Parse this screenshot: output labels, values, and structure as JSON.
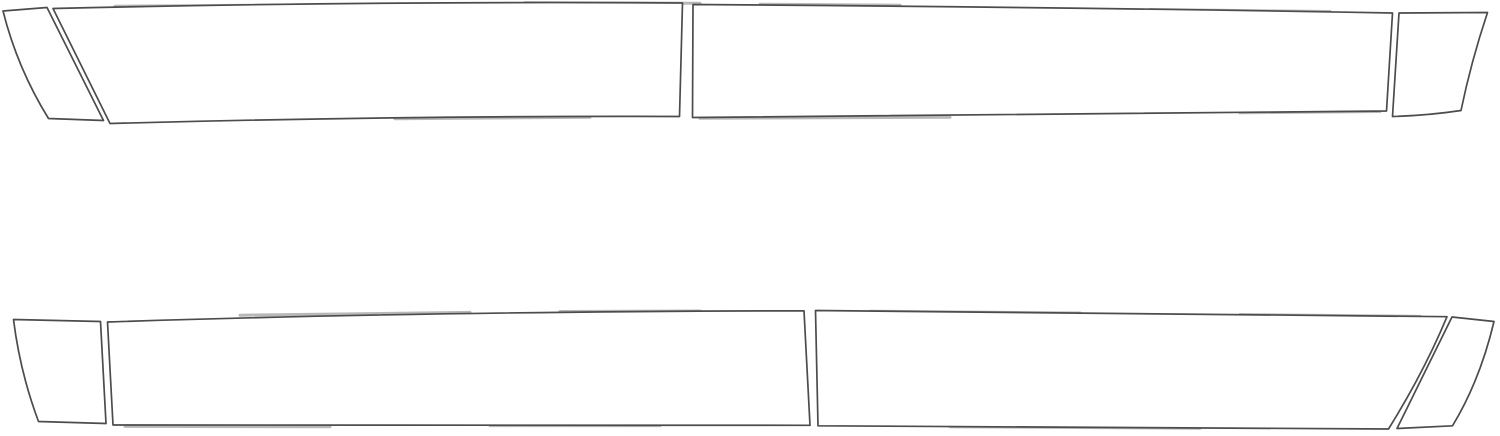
{
  "canvas": {
    "width": 1500,
    "height": 436,
    "viewbox": "0 0 1500 436",
    "background": "#ffffff"
  },
  "style": {
    "outline_color": "#4c4c4c",
    "outline_width": 1.7,
    "piece_fill": "#ffffff",
    "artifact_color": "#b8b8b8",
    "artifact_width": 3
  },
  "diagram": {
    "kind": "precut-film-template-outlines",
    "rows": [
      {
        "id": "top-row",
        "piece_count": 4
      },
      {
        "id": "bottom-row",
        "piece_count": 4
      }
    ]
  },
  "pieces": [
    {
      "id": "top-front-fender-strip",
      "row": "top-row",
      "path": "M 3,11 L 47,7.5 L 103.5,120.5 L 48.5,118.5 Q 17.5,68.5 3,11 Z"
    },
    {
      "id": "top-front-door-panel",
      "row": "top-row",
      "path": "M 53,8.5 Q 372,1 682.5,3 L 679.5,116.5 Q 405,115.5 110,123.5 Z"
    },
    {
      "id": "top-rear-door-panel",
      "row": "top-row",
      "path": "M 693,4.5 Q 1057,7 1392.5,13 L 1386.5,111 Q 1040,114.5 692.5,117.5 Z"
    },
    {
      "id": "top-rear-quarter-strip",
      "row": "top-row",
      "path": "M 1399,13 L 1487.5,12.5 Q 1471,62 1461,110.5 Q 1428,115.5 1392.5,116.5 Z"
    },
    {
      "id": "bottom-front-fender-strip",
      "row": "bottom-row",
      "path": "M 13.5,319.5 L 100.5,321.5 L 106,423.5 L 38.5,421.5 Q 20,372 13.5,319.5 Z"
    },
    {
      "id": "bottom-front-door-panel",
      "row": "bottom-row",
      "path": "M 107.5,322 Q 420,311.5 804,310.8 L 810,425.3 L 113,425 Z"
    },
    {
      "id": "bottom-rear-door-panel",
      "row": "bottom-row",
      "path": "M 815.5,310.5 L 1447,316.7 Q 1424,372 1388.5,429 L 818,425.8 Z"
    },
    {
      "id": "bottom-rear-quarter-strip",
      "row": "bottom-row",
      "path": "M 1452,317 L 1494,321.5 Q 1480,380.5 1452.5,425.8 L 1397,428.5 Z"
    }
  ],
  "edge_artifacts": [
    {
      "path": "M 115,6.2 L 330,4.8"
    },
    {
      "path": "M 525,2.6 L 700,3.2"
    },
    {
      "path": "M 760,4.2 L 900,5.2"
    },
    {
      "path": "M 1150,9.5 L 1330,11.5"
    },
    {
      "path": "M 395,118.8 L 590,117.3"
    },
    {
      "path": "M 700,118.2 L 950,117.2"
    },
    {
      "path": "M 1240,112.8 L 1380,111.5"
    },
    {
      "path": "M 240,315.2 L 470,312.4"
    },
    {
      "path": "M 560,311.5 L 700,311"
    },
    {
      "path": "M 870,311.2 L 1080,313"
    },
    {
      "path": "M 1240,314.6 L 1420,316.4"
    },
    {
      "path": "M 125,426.4 L 330,426.8"
    },
    {
      "path": "M 490,425.6 L 660,425.6"
    },
    {
      "path": "M 950,426.8 L 1200,428.2"
    }
  ]
}
